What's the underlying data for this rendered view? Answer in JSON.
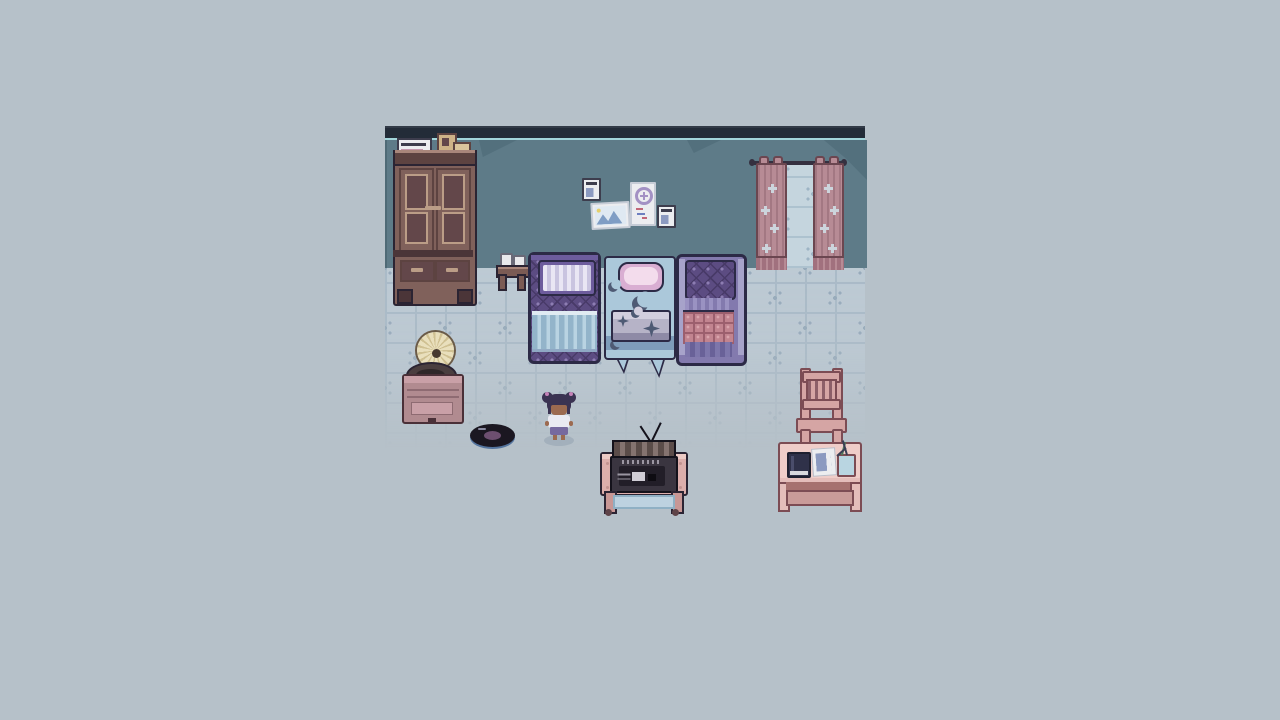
{
  "meta": {
    "domain": "pixel-art game scene",
    "description": "Top-down pixel-art bedroom: wardrobe, pinned papers, curtained window, three beds, gramophone, vinyl record, child character, CRT TV on table, desk and chair"
  },
  "palette": {
    "bg": "#b6c1c9",
    "tileBase": "#bdcad4",
    "tileLine": "#a9bac7",
    "tileCross": "#95a9ba",
    "wall": "#5e7b88",
    "wallShadow": "#53707d",
    "topBand": "#232c38",
    "topLine": "#a2d5da",
    "outlineDark": "#2b2433",
    "navyOutline": "#2c2a46",
    "wood": "#80615b",
    "woodDark": "#5d4341",
    "woodDoor": "#63474a",
    "woodLight": "#a9867b",
    "woodTrim": "#bb9d87",
    "woodBase": "#4b3538",
    "paper": "#ecedf0",
    "paperLine": "#8c9ac0",
    "paperDark": "#3d3d4d",
    "paperPink": "#c497ae",
    "boxTan": "#cdb287",
    "cardTan": "#d9c49c",
    "photoSky": "#dfe9f2",
    "photoMtn": "#7f9dc4",
    "photoStar": "#e5cf6a",
    "posterRing": "#a391c4",
    "posterRed": "#c26678",
    "posterBlue": "#6d7fc0",
    "rod": "#353040",
    "curtain": "#b78b95",
    "curtainDark": "#a1717e",
    "curtainOutline": "#6b4650",
    "curtainSparkle": "#ccd4dc",
    "windowLight": "#c5d5de",
    "windowLine": "#adc2cf",
    "windowCross": "#9db4c4",
    "bedPurple": "#5c4c82",
    "bedPurpleDark": "#483a68",
    "bedPurpleDot": "#8d7db2",
    "bedHead": "#6d5c9d",
    "pillowStripeA": "#e9e6f4",
    "pillowStripeB": "#c9c4e0",
    "blanketBlue": "#b9d3e2",
    "blanketBlueLight": "#e0ebf2",
    "blanketBlueLine": "#93b4ca",
    "blanketBlueEdge": "#8fa8c4",
    "matBlue": "#abc8da",
    "matBlueDark": "#7e9cba",
    "matPillow": "#d9aed2",
    "matPillowLight": "#f3dcec",
    "moon": "#4e5a74",
    "matBlanket": "#d2cede",
    "matBlanketLight": "#b6b3c7",
    "matBlanketDark": "#8e8aa6",
    "bed3Rail": "#a7a3ca",
    "bed3StripeA": "#9a92c2",
    "bed3StripeB": "#837aae",
    "bed3BottomA": "#7d76ab",
    "bed3BottomB": "#696198",
    "plaid": "#c28490",
    "plaidDark": "#9c5f6e",
    "plaidLight": "#d8a3ab",
    "standWood": "#7b5b54",
    "cupWhite": "#e9e9ec",
    "hornCream": "#e9dfbc",
    "hornShade": "#cfc092",
    "hornDark": "#6b5b48",
    "turntable": "#4a3e3f",
    "turntableDark": "#2f2729",
    "gramoPink": "#b18b90",
    "gramoPinkLight": "#c9a0a7",
    "gramoPinkDark": "#8e6b72",
    "gramoOutline": "#4a3038",
    "vinylBlack": "#1b1721",
    "vinylLabel": "#6d4f70",
    "vinylRim": "#54749e",
    "hair": "#3b3352",
    "scrunchie": "#c583b8",
    "skin": "#9c6a50",
    "shirt": "#eaeaf2",
    "shorts": "#76699f",
    "charShadow": "#93a3b0",
    "tvOutline": "#14121b",
    "tvTop": "#857370",
    "tvTopDark": "#5b4c49",
    "tvBody": "#3a3540",
    "tvVent": "#9b96a2",
    "tvInner": "#221e28",
    "tvPlate": "#d0cdd5",
    "tvTablePink": "#dcaeab",
    "tvTableLight": "#eccac5",
    "tvTableDark": "#c1928f",
    "tvLeg": "#c89795",
    "caster": "#5e4348",
    "shelfBlue": "#bdd2e0",
    "shelfEdge": "#8fb0c4",
    "chairPink": "#d5a5a4",
    "chairSlat": "#8c5f68",
    "deskPink": "#e4bdba",
    "deskLight": "#efcdc9",
    "deskDark": "#7c4c54",
    "deskRail": "#c99b99",
    "deskShadow": "#a6716f",
    "book": "#2f3149",
    "bookLight": "#4a4d6b",
    "bookPage": "#d9d9de",
    "cupBlue": "#b9d5e1",
    "pencilGreen": "#4d7a5a",
    "pencilDark": "#3a3f55"
  },
  "scene": {
    "room": {
      "x": 385,
      "y": 126,
      "width": 480,
      "wall_height": 130,
      "tile_size": 30
    },
    "objects": [
      {
        "id": "wardrobe",
        "label": "Wardrobe with papers and boxes on top"
      },
      {
        "id": "wall-papers",
        "label": "Notes, photo and poster pinned to the wall"
      },
      {
        "id": "curtains",
        "label": "Pink curtains over a bright window"
      },
      {
        "id": "nightstand",
        "label": "Small table with two cups"
      },
      {
        "id": "bed-left",
        "label": "Purple patterned bed with striped pillow and blue blanket"
      },
      {
        "id": "sleeping-mat",
        "label": "Blue moon-print sleeping mat with pink pillow and folded blanket"
      },
      {
        "id": "bed-right",
        "label": "Purple bed with pink plaid blanket"
      },
      {
        "id": "gramophone",
        "label": "Gramophone record player"
      },
      {
        "id": "vinyl-record",
        "label": "Vinyl record lying on the floor"
      },
      {
        "id": "player",
        "label": "Child character with hair buns, white shirt and purple shorts"
      },
      {
        "id": "tv",
        "label": "CRT television seen from behind with antennas"
      },
      {
        "id": "tv-table",
        "label": "Pink table with blue lower shelf on casters"
      },
      {
        "id": "chair",
        "label": "Pink wooden chair"
      },
      {
        "id": "desk",
        "label": "Desk with book, paper sheet and pencil cup"
      }
    ]
  }
}
